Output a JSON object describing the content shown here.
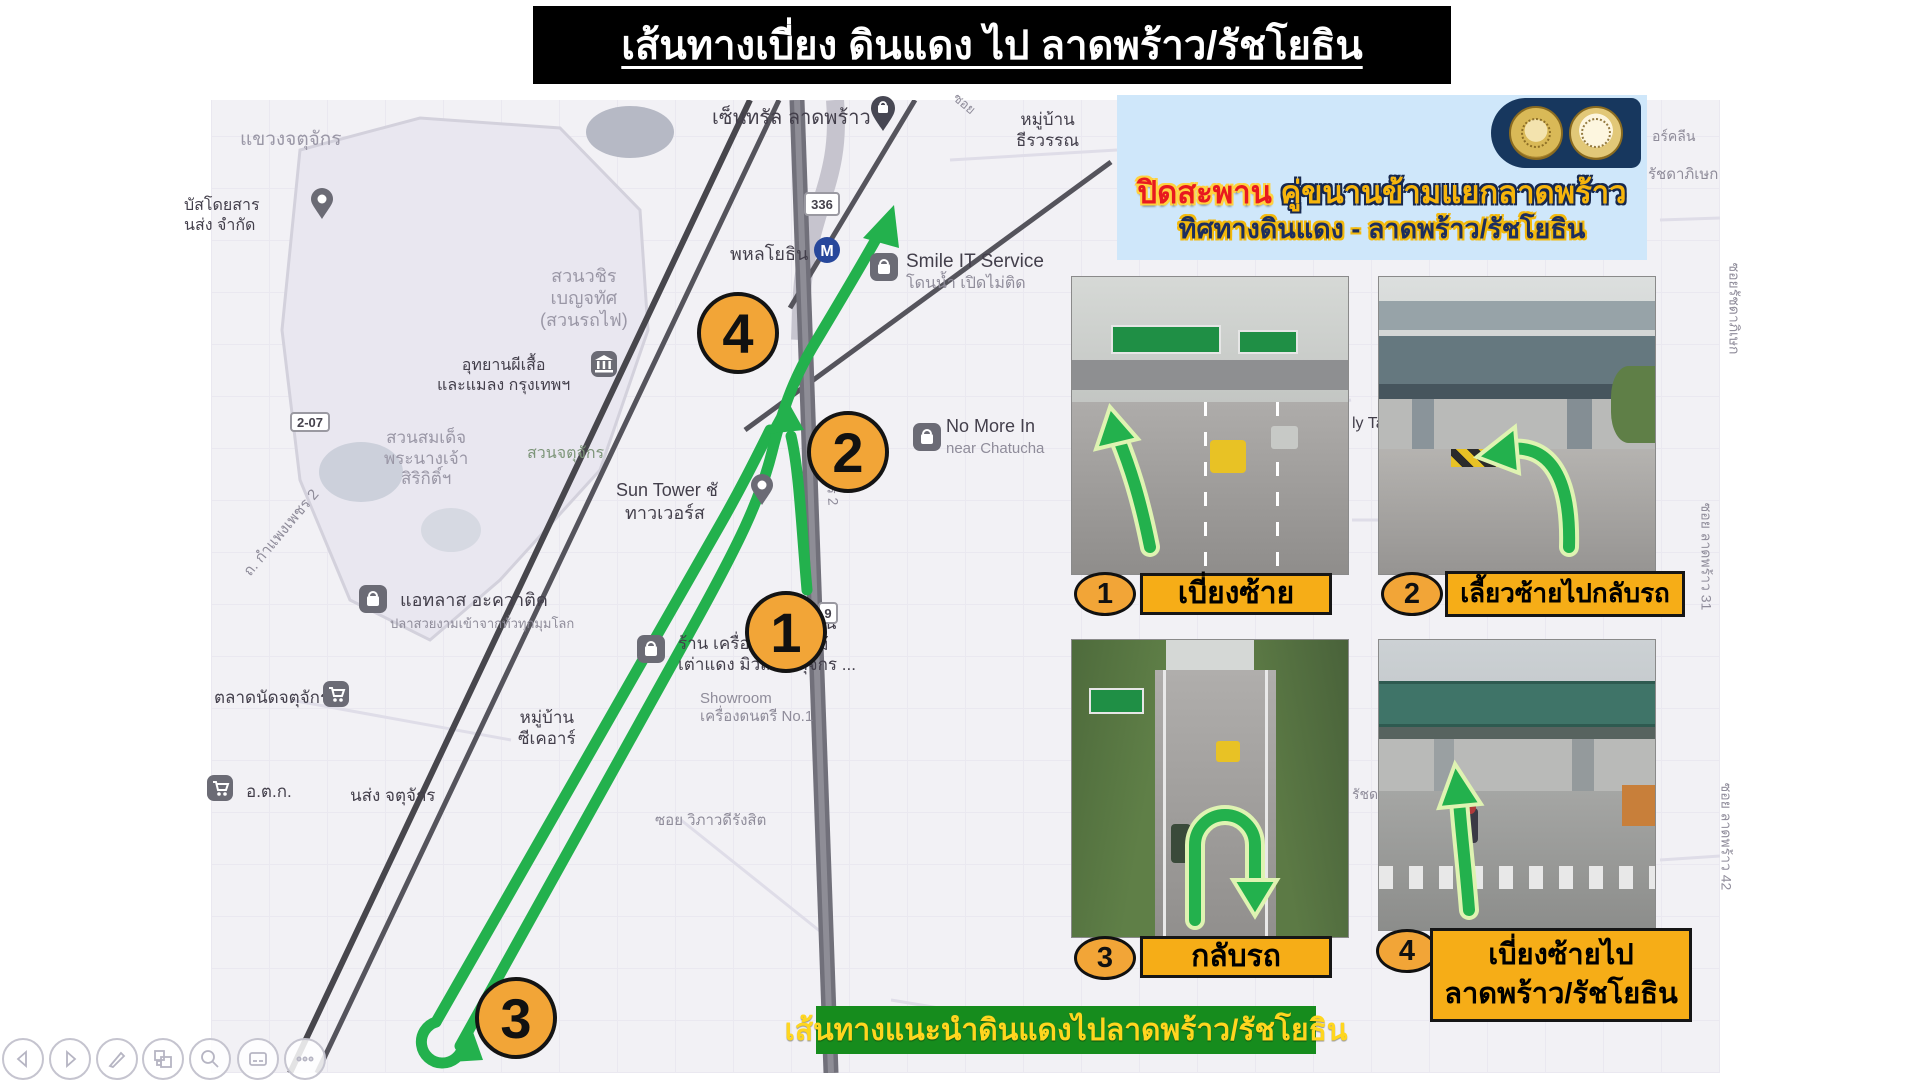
{
  "title": {
    "text": "เส้นทางเบี่ยง ดินแดง ไป ลาดพร้าว/รัชโยธิน"
  },
  "notice_banner": {
    "line1_red": "ปิดสะพาน",
    "line1_gold": " คู่ขนานข้ามแยกลาดพร้าว",
    "line2": "ทิศทางดินแดง - ลาดพร้าว/รัชโยธิน",
    "seals": [
      "thai-government-seal",
      "department-of-highways-seal"
    ],
    "bg_color": "#cfe7fa"
  },
  "route_banner": {
    "text": "เส้นทางแนะนำดินแดงไปลาดพร้าว/รัชโยธิน",
    "bg_color": "#168c1d",
    "text_color": "#ffd61f"
  },
  "route_color": "#23b14d",
  "map": {
    "labels": [
      {
        "text": "แขวงจตุจักร",
        "x": 240,
        "y": 128,
        "size": 19,
        "color": "#9a97a6"
      },
      {
        "lines": [
          "บัสโดยสาร",
          "นส่ง จำกัด"
        ],
        "x": 184,
        "y": 196,
        "size": 16,
        "color": "#433f4b"
      },
      {
        "text": "เซ็นทรัล ลาดพร้าว",
        "x": 712,
        "y": 106,
        "size": 20,
        "color": "#433f4b"
      },
      {
        "lines": [
          "หมู่บ้าน",
          "ธีรวรรณ"
        ],
        "x": 1016,
        "y": 110,
        "size": 17,
        "color": "#433f4b",
        "center": true
      },
      {
        "text": "พหลโยธิน",
        "x": 730,
        "y": 244,
        "size": 18,
        "color": "#433f4b"
      },
      {
        "text": "Smile IT Service",
        "x": 906,
        "y": 250,
        "size": 19,
        "color": "#433f4b"
      },
      {
        "text": "โดนน้ำ เปิดไม่ติด",
        "x": 906,
        "y": 274,
        "size": 16,
        "color": "#8f8c9a"
      },
      {
        "lines": [
          "สวนวชิร",
          "เบญจทัศ",
          "(สวนรถไฟ)"
        ],
        "x": 540,
        "y": 266,
        "size": 18,
        "color": "#9a97a6",
        "center": true
      },
      {
        "lines": [
          "อุทยานผีเสื้อ",
          "และแมลง กรุงเทพฯ"
        ],
        "x": 437,
        "y": 356,
        "size": 16,
        "color": "#433f4b",
        "center": true
      },
      {
        "text": "No More In",
        "x": 946,
        "y": 416,
        "size": 18,
        "color": "#433f4b"
      },
      {
        "text": "near Chatucha",
        "x": 946,
        "y": 440,
        "size": 15,
        "color": "#8f8c9a"
      },
      {
        "lines": [
          "สวนสมเด็จ",
          "พระนางเจ้า",
          "สิริกิติ์ฯ"
        ],
        "x": 384,
        "y": 428,
        "size": 17,
        "color": "#9a97a6",
        "center": true
      },
      {
        "text": "สวนจตุจักร",
        "x": 527,
        "y": 444,
        "size": 16,
        "color": "#7d9579"
      },
      {
        "text": "Sun Tower ชั",
        "x": 616,
        "y": 480,
        "size": 18,
        "color": "#433f4b"
      },
      {
        "text": "ทาวเวอร์ส",
        "x": 625,
        "y": 503,
        "size": 18,
        "color": "#433f4b"
      },
      {
        "text": "แอทลาส อะควาติค",
        "x": 400,
        "y": 590,
        "size": 18,
        "color": "#433f4b"
      },
      {
        "text": "ปลาสวยงามเข้าจากทั่วทุกมุมโลก",
        "x": 390,
        "y": 616,
        "size": 13,
        "color": "#8f8c9a"
      },
      {
        "lines": [
          "ร้าน เครื่องดนตรี",
          "เต่าแดง มิวสิค จตุจักร ..."
        ],
        "x": 678,
        "y": 634,
        "size": 17,
        "color": "#433f4b"
      },
      {
        "lines": [
          "Showroom",
          "เครื่องดนตรี No.1"
        ],
        "x": 700,
        "y": 690,
        "size": 15,
        "color": "#8f8c9a"
      },
      {
        "lines": [
          "หมู่บ้าน",
          "วิวไม้"
        ],
        "x": 782,
        "y": 614,
        "size": 17,
        "color": "#433f4b",
        "center": true
      },
      {
        "lines": [
          "หมู่บ้าน",
          "ซีเคอาร์"
        ],
        "x": 518,
        "y": 708,
        "size": 17,
        "color": "#433f4b",
        "center": true
      },
      {
        "text": "ตลาดนัดจตุจักร",
        "x": 214,
        "y": 688,
        "size": 17,
        "color": "#433f4b"
      },
      {
        "text": "อ.ต.ก.",
        "x": 246,
        "y": 782,
        "size": 17,
        "color": "#433f4b"
      },
      {
        "text": "นส่ง จตุจักร",
        "x": 350,
        "y": 786,
        "size": 17,
        "color": "#433f4b"
      },
      {
        "text": "ซอย วิภาวดีรังสิต",
        "x": 655,
        "y": 812,
        "size": 15,
        "color": "#8f8c9a"
      },
      {
        "text": "ถ. กำแพงเพชร 2",
        "x": 228,
        "y": 524,
        "size": 15,
        "color": "#8f8c9a",
        "rot": -50
      },
      {
        "text": "กำแพงเพชร 2",
        "x": 788,
        "y": 455,
        "size": 14,
        "color": "#8f8c9a",
        "rot": 86
      },
      {
        "text": "ซอย",
        "x": 952,
        "y": 96,
        "size": 13,
        "color": "#8f8c9a",
        "rot": 40
      },
      {
        "text": "อร์คลีน",
        "x": 1652,
        "y": 128,
        "size": 14,
        "color": "#8f8c9a"
      },
      {
        "text": "รัชดาภิเษก",
        "x": 1648,
        "y": 166,
        "size": 15,
        "color": "#8f8c9a"
      },
      {
        "text": "ซอยรัชดาภิเษก",
        "x": 1688,
        "y": 300,
        "size": 14,
        "color": "#8f8c9a",
        "rot": 90
      },
      {
        "text": "ly Ta",
        "x": 1352,
        "y": 414,
        "size": 16,
        "color": "#433f4b"
      },
      {
        "text": "ซอย ลาดพร้าว 31",
        "x": 1652,
        "y": 548,
        "size": 14,
        "color": "#8f8c9a",
        "rot": 90
      },
      {
        "text": "รัชด",
        "x": 1352,
        "y": 786,
        "size": 14,
        "color": "#8f8c9a"
      },
      {
        "text": "ซอย ลาดพร้าว 42",
        "x": 1672,
        "y": 828,
        "size": 14,
        "color": "#8f8c9a",
        "rot": 90
      }
    ],
    "pois": [
      {
        "type": "pinbag",
        "x": 884,
        "y": 112,
        "name": "central-ladprao-pin"
      },
      {
        "type": "pin",
        "x": 324,
        "y": 204,
        "name": "bus-terminal-pin"
      },
      {
        "type": "metro",
        "x": 827,
        "y": 252,
        "name": "phahonyothin-metro-icon",
        "letter": "M"
      },
      {
        "type": "bag",
        "x": 883,
        "y": 268,
        "name": "smile-it-service-icon"
      },
      {
        "type": "bag",
        "x": 926,
        "y": 438,
        "name": "no-more-icon"
      },
      {
        "type": "museum",
        "x": 604,
        "y": 366,
        "name": "butterfly-garden-icon"
      },
      {
        "type": "pin",
        "x": 764,
        "y": 490,
        "name": "sun-tower-pin"
      },
      {
        "type": "bag",
        "x": 372,
        "y": 600,
        "name": "atlas-aquatic-icon"
      },
      {
        "type": "bag",
        "x": 650,
        "y": 650,
        "name": "taodang-music-icon"
      },
      {
        "type": "cart",
        "x": 336,
        "y": 696,
        "name": "chatuchak-market-icon"
      },
      {
        "type": "cart",
        "x": 220,
        "y": 790,
        "name": "otk-market-icon"
      }
    ],
    "markers": [
      {
        "n": "1",
        "x": 786,
        "y": 632
      },
      {
        "n": "2",
        "x": 848,
        "y": 452
      },
      {
        "n": "3",
        "x": 516,
        "y": 1018
      },
      {
        "n": "4",
        "x": 738,
        "y": 333
      }
    ],
    "shields": [
      {
        "text": "336",
        "x": 804,
        "y": 192,
        "w": 36,
        "h": 24
      },
      {
        "text": "9",
        "x": 818,
        "y": 602,
        "w": 20,
        "h": 22
      },
      {
        "text": "2-07",
        "x": 290,
        "y": 412,
        "w": 40,
        "h": 20
      }
    ]
  },
  "photos": [
    {
      "number": "1",
      "caption": "เบี่ยงซ้าย"
    },
    {
      "number": "2",
      "caption": "เลี้ยวซ้ายไปกลับรถ"
    },
    {
      "number": "3",
      "caption": "กลับรถ"
    },
    {
      "number": "4",
      "caption_line1": "เบี่ยงซ้ายไป",
      "caption_line2": "ลาดพร้าว/รัชโยธิน"
    }
  ],
  "controls": {
    "items": [
      {
        "type": "prev",
        "label": "previous-slide"
      },
      {
        "type": "next",
        "label": "next-slide"
      },
      {
        "type": "pen",
        "label": "pen-tools"
      },
      {
        "type": "slides",
        "label": "see-all-slides"
      },
      {
        "type": "zoom",
        "label": "zoom-slide"
      },
      {
        "type": "captions",
        "label": "toggle-subtitles"
      },
      {
        "type": "more",
        "label": "more-options"
      }
    ]
  }
}
